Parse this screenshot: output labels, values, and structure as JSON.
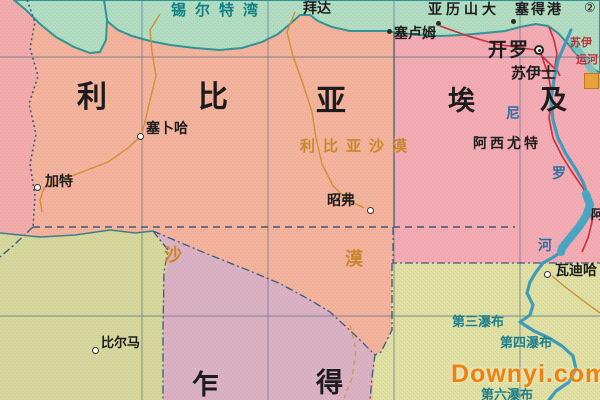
{
  "map_title": "利比亚及周边地区地图",
  "colors": {
    "libya_fill": "#f4b39c",
    "egypt_fill": "#f3abb4",
    "algeria_fill": "#f2acab",
    "niger_fill": "#d6d79c",
    "chad_fill": "#dbb2c4",
    "sudan_fill": "#e0e0a4",
    "sea_fill": "#b2ddc2",
    "coast_stroke": "#2f9596",
    "river_stroke": "#3f9cb8",
    "railway_red": "#c63040",
    "road_orange": "#cf8f33",
    "border_blue": "#3c5a80",
    "desert_text": "#c9872b",
    "watermark_orange": "#f2800f"
  },
  "labels": {
    "gulf_of_sirte": "锡尔特湾",
    "baida": "拜达",
    "alexandria": "亚历山大",
    "port_said": "塞得港",
    "footnote_2": "②",
    "sallum": "塞卢姆",
    "cairo": "开罗",
    "suez": "苏伊士",
    "suez_canal_part1": "苏伊",
    "suez_canal_part2": "运河",
    "libya_char1": "利",
    "libya_char2": "比",
    "libya_char3": "亚",
    "egypt_char1": "埃",
    "egypt_char2": "及",
    "sabha": "塞卜哈",
    "libyan_desert": "利比亚沙漠",
    "ghat": "加特",
    "asyut": "阿西尤特",
    "nile_char1": "尼",
    "nile_char2": "罗",
    "nile_char3": "河",
    "jawf": "昭弗",
    "sahara_char1": "沙",
    "sahara_char2": "漠",
    "aswan_partial": "阿",
    "wadi_halfa": "瓦迪哈",
    "bilma": "比尔马",
    "cataract_3": "第三瀑布",
    "cataract_4": "第四瀑布",
    "cataract_6": "第六瀑布",
    "chad_char1": "乍",
    "chad_char2": "得",
    "watermark": "Downyi.com"
  }
}
